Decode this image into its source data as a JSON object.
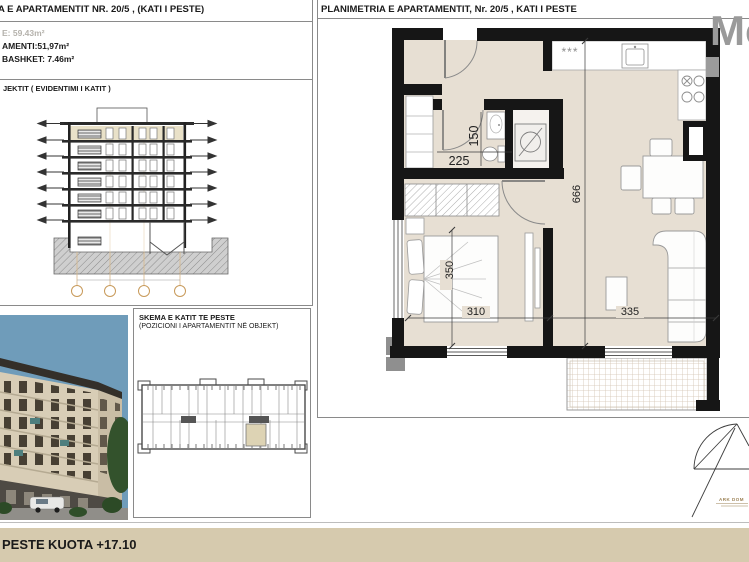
{
  "title_block": {
    "line1": "A E APARTAMENTIT NR. 20/5 , (KATI I PESTE)",
    "line2": "E: 59.43m²",
    "line3": "AMENTI:51,97m²",
    "line4": "BASHKET: 7.46m²"
  },
  "section_panel": {
    "label": "JEKTIT ( EVIDENTIMI I KATIT )"
  },
  "key_plan": {
    "title": "SKEMA E KATIT TE PESTE",
    "subtitle": "(POZICIONI I APARTAMENTIT NË OBJEKT)"
  },
  "plan": {
    "header": "PLANIMETRIA E APARTAMENTIT, Nr. 20/5 , KATI I PESTE",
    "kitchen_symbol": "***",
    "dims": {
      "bath_width": "225",
      "bath_height": "150",
      "apartment_depth": "666",
      "bedroom_depth": "350",
      "bedroom_width": "310",
      "living_width": "335"
    }
  },
  "footer": {
    "floor": "PESTE",
    "kuota": "KUOTA +17.10"
  },
  "watermark": "Mo",
  "stamp": {
    "firm": "ARK DOM"
  },
  "colors": {
    "floor": "#e7dfd3",
    "wall": "#161616",
    "footer_bar": "#d6caae",
    "section_highlight": "#e9e1c8",
    "grid_bubble": "#c89a5a",
    "watermark": "#9a9a9a",
    "sky": "#6f9cba",
    "keyplan_highlight": "#ddd3b4"
  }
}
